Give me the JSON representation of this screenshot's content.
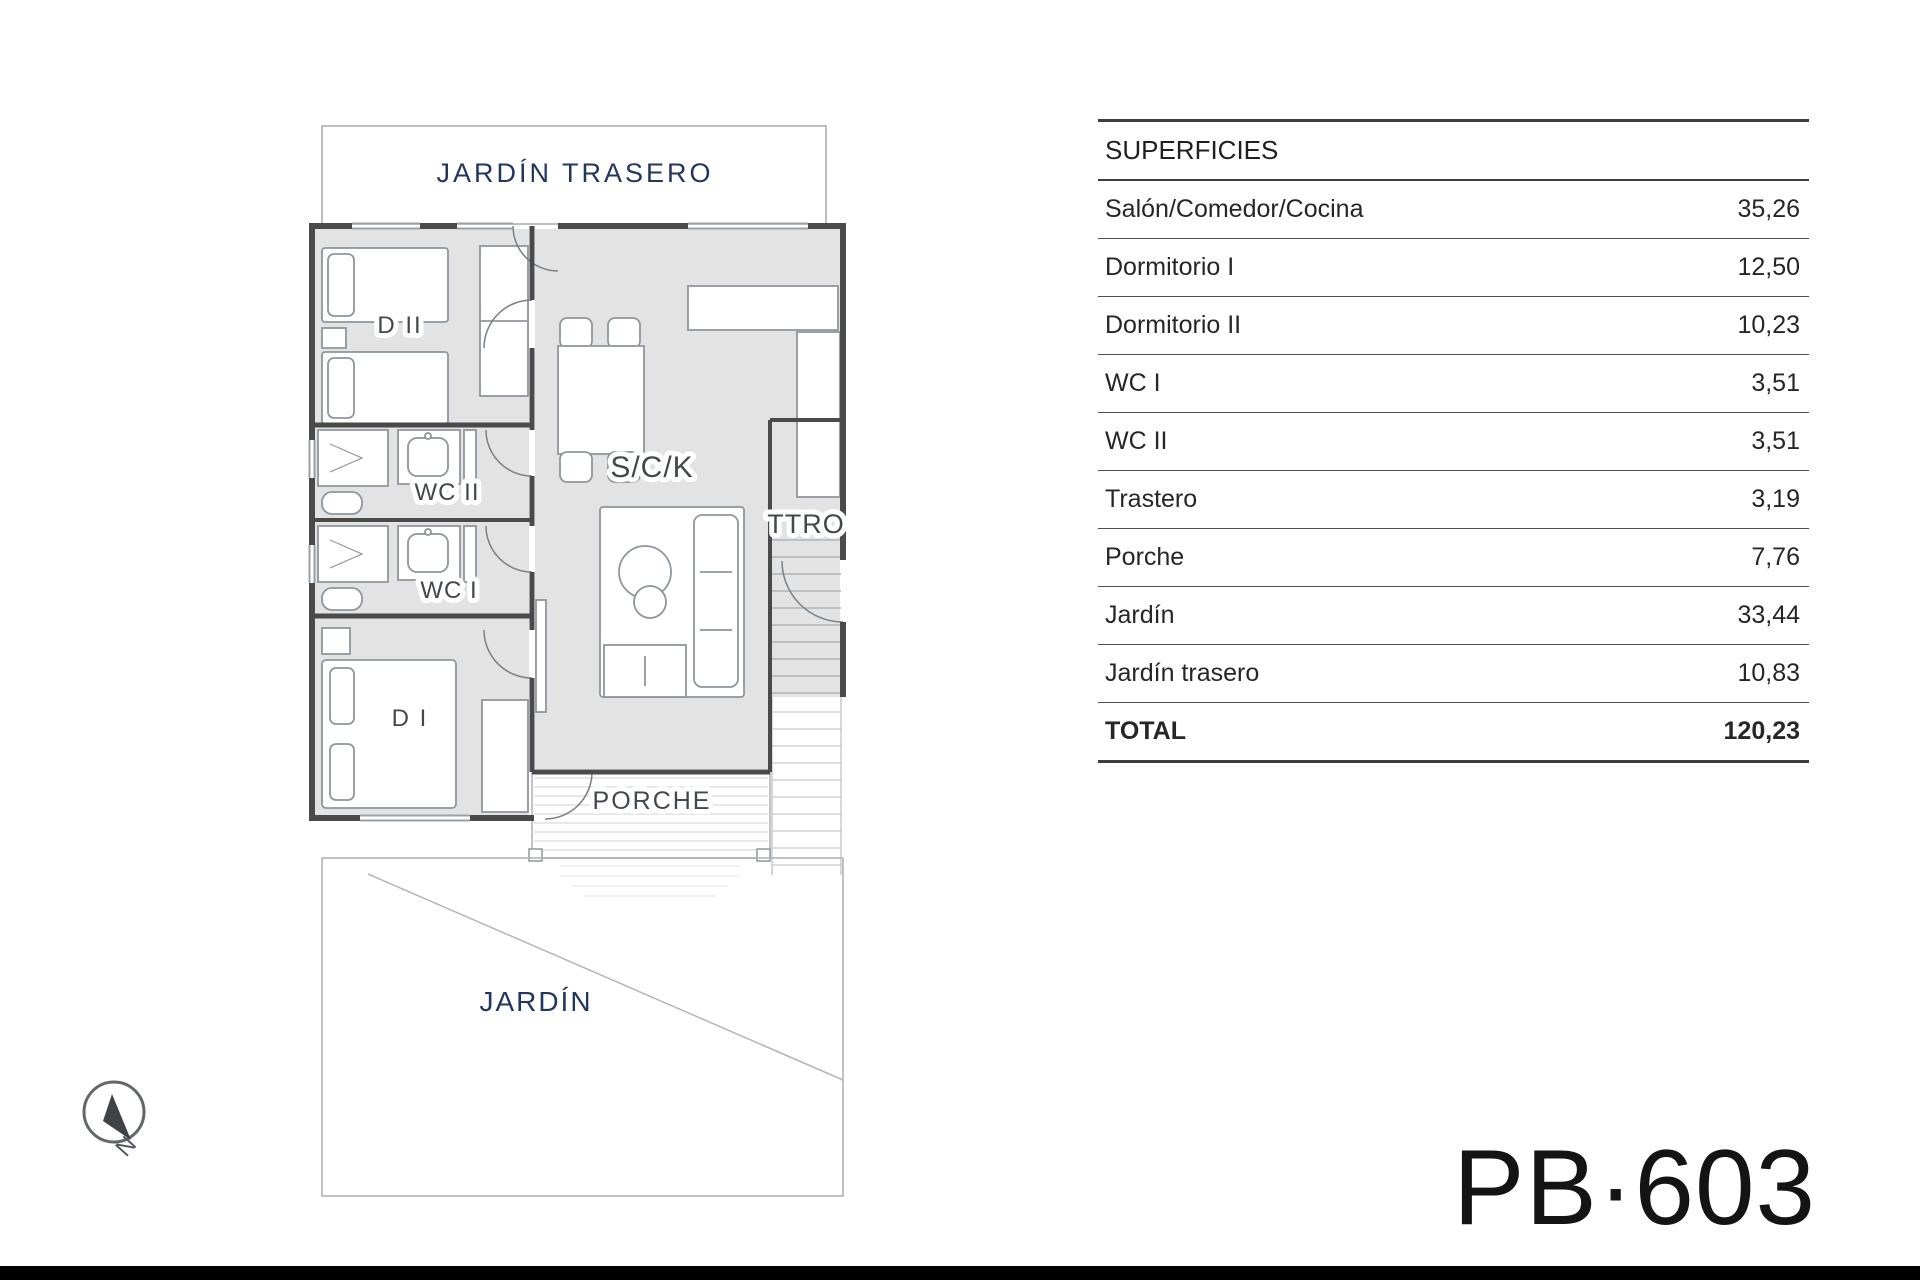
{
  "plan": {
    "labels": {
      "jardin_trasero": "JARDÍN TRASERO",
      "d2": "D II",
      "wc2": "WC II",
      "wc1": "WC I",
      "d1": "D I",
      "sck": "S/C/K",
      "ttro": "TTRO",
      "porche": "PORCHE",
      "jardin": "JARDÍN",
      "compass": "N"
    }
  },
  "table": {
    "header": "SUPERFICIES",
    "rows": [
      {
        "label": "Salón/Comedor/Cocina",
        "value": "35,26"
      },
      {
        "label": "Dormitorio I",
        "value": "12,50"
      },
      {
        "label": "Dormitorio II",
        "value": "10,23"
      },
      {
        "label": "WC I",
        "value": "3,51"
      },
      {
        "label": "WC II",
        "value": "3,51"
      },
      {
        "label": "Trastero",
        "value": "3,19"
      },
      {
        "label": "Porche",
        "value": "7,76"
      },
      {
        "label": "Jardín",
        "value": "33,44"
      },
      {
        "label": "Jardín trasero",
        "value": "10,83"
      }
    ],
    "total": {
      "label": "TOTAL",
      "value": "120,23"
    }
  },
  "plan_code": "PB·603",
  "colors": {
    "wall": "#4a4a4a",
    "floor": "#e3e3e4",
    "navy": "#24365e",
    "text": "#262626"
  }
}
